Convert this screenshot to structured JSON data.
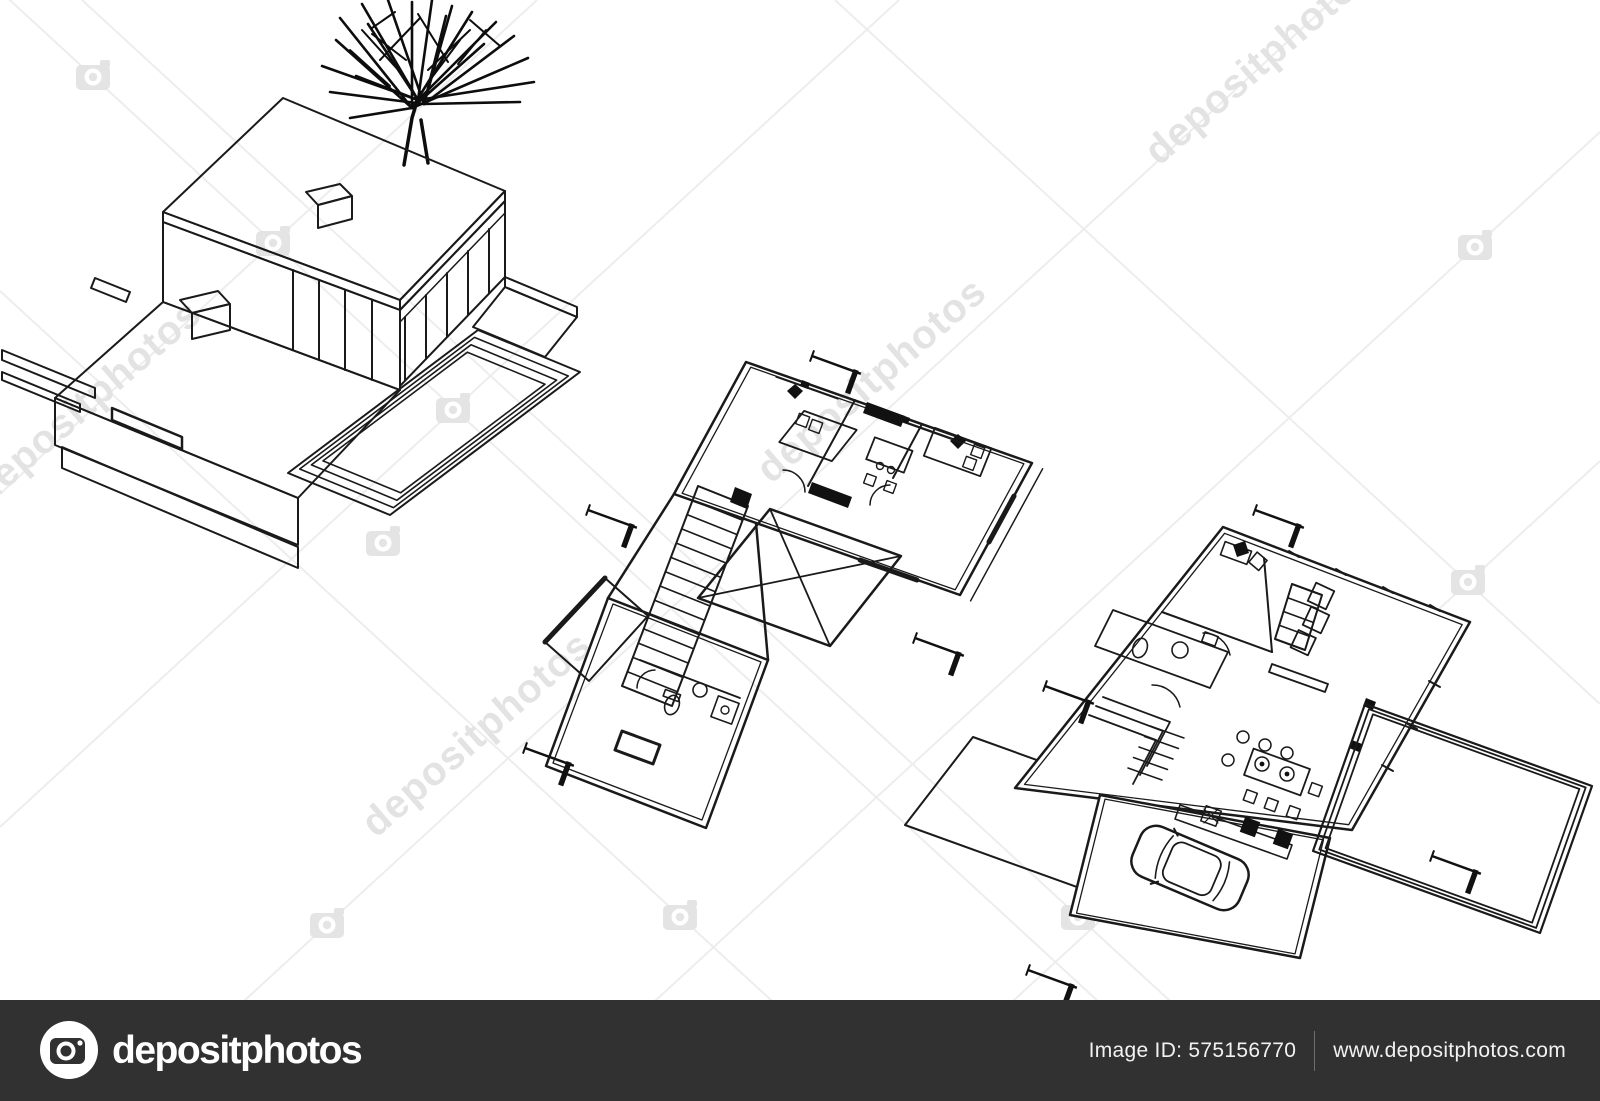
{
  "image": {
    "description": "black and white architectural sketch: 3d modern house perspective with tree, first floor plan and ground floor plan with car and pool terrace",
    "background_color": "#ffffff",
    "line_color": "#1a1a1a"
  },
  "watermark": {
    "text": "depositphotos",
    "text_color": "#e3e3e3",
    "lattice_color": "#ededed",
    "icon": "camera-icon"
  },
  "footer": {
    "bar_color": "#313131",
    "logo_icon": "camera-icon",
    "logo_text": "depositphotos",
    "image_id": "Image ID: 575156770",
    "website": "www.depositphotos.com",
    "text_color": "#f2f2f2"
  }
}
